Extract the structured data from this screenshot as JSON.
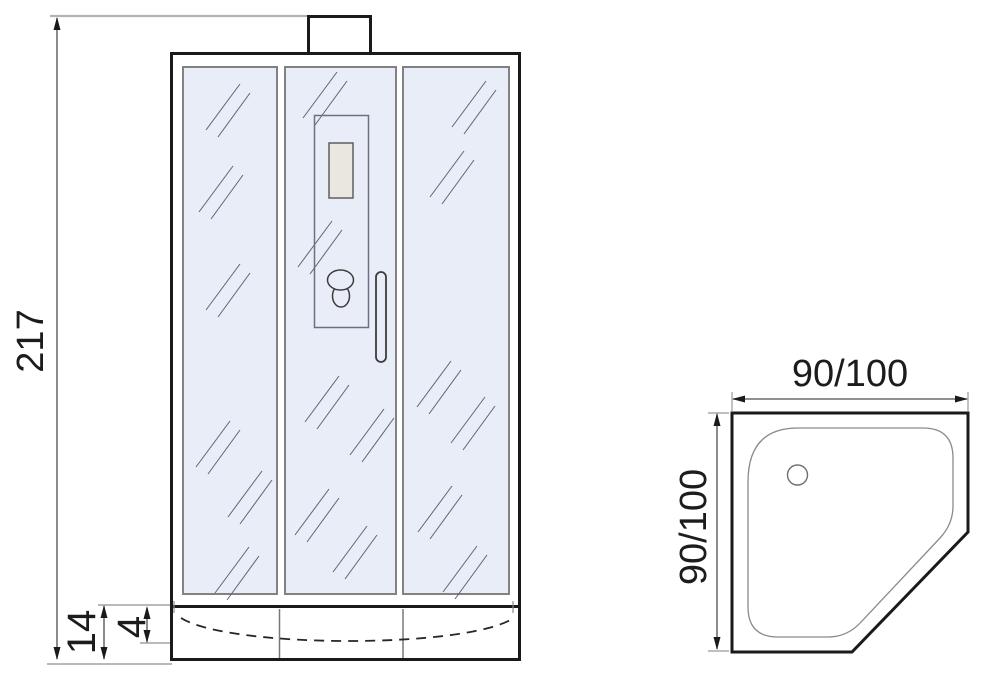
{
  "front_view": {
    "overall_height_label": "217",
    "tray_height_label": "14",
    "tray_inner_depth_label": "4"
  },
  "top_view": {
    "width_label": "90/100",
    "depth_label": "90/100"
  },
  "colors": {
    "glass_fill": "#e9edf8",
    "outline": "#1a1a1a",
    "panel_border": "#828282",
    "inset_panel_fill": "#eae7e1",
    "dimension_line": "#4d4d4d",
    "extension_line": "#b3b3b3"
  }
}
